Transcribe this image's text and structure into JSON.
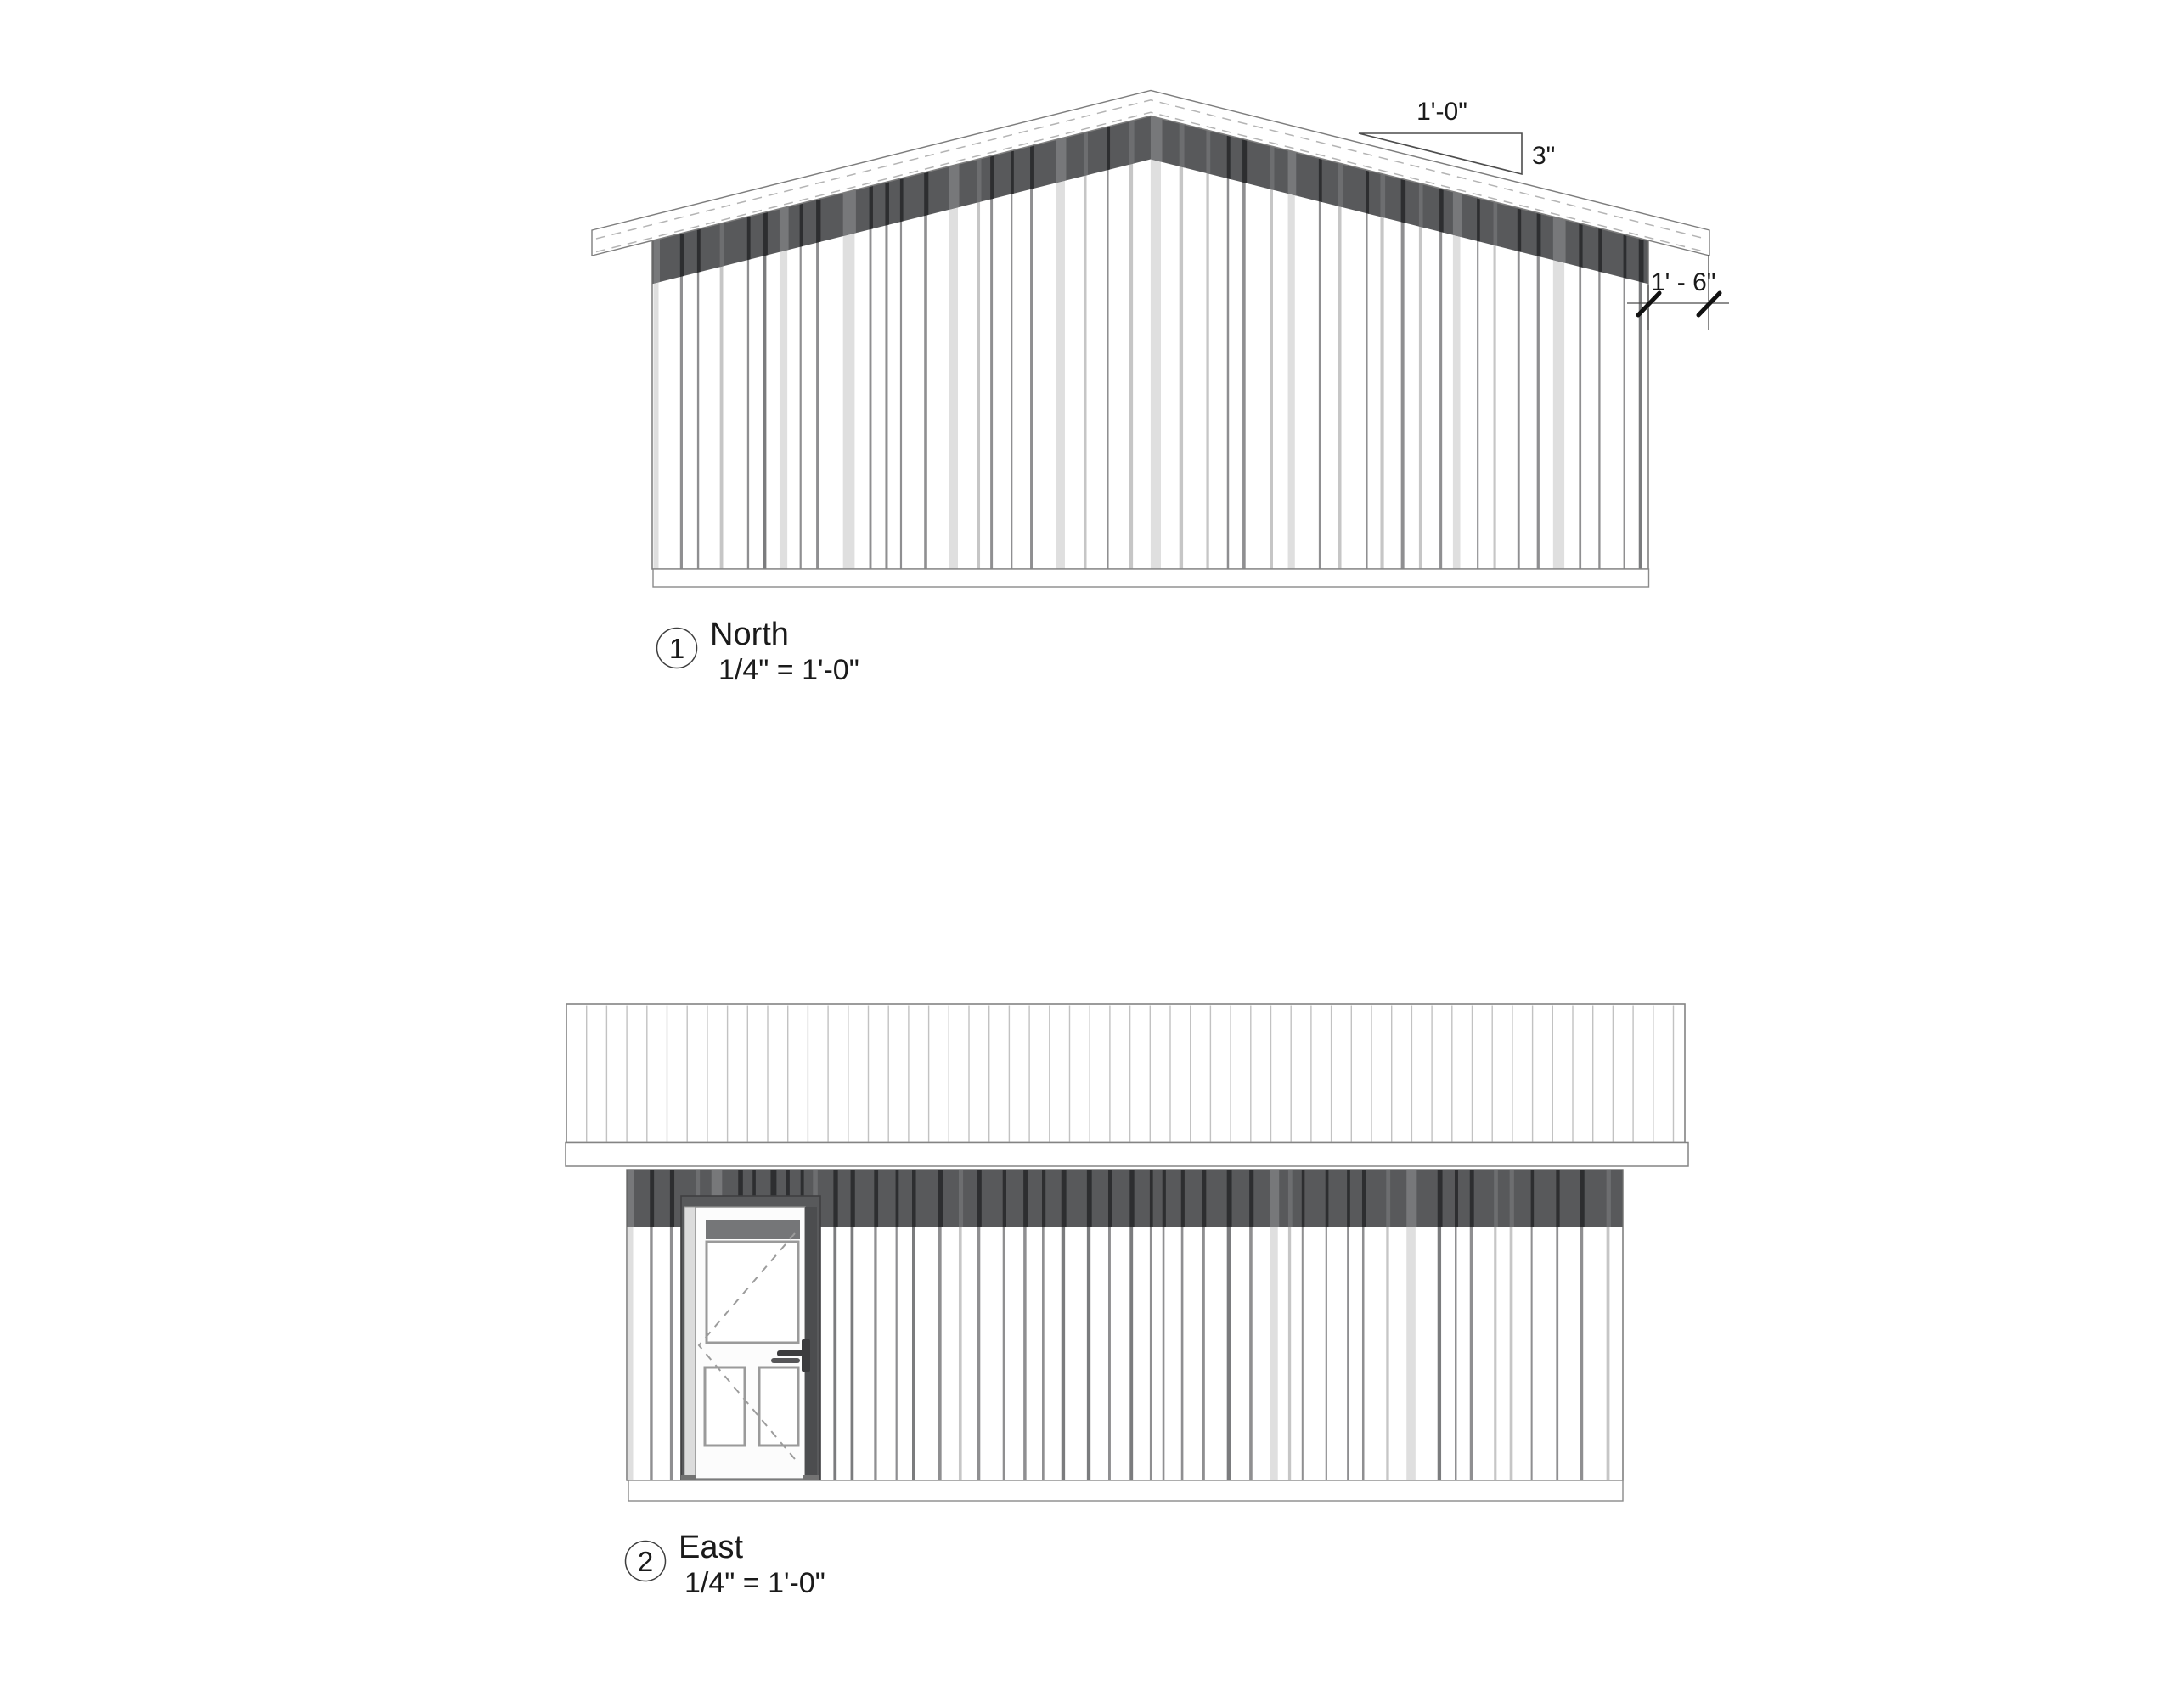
{
  "sheet": {
    "background": "#ffffff"
  },
  "views": [
    {
      "number": "1",
      "title": "North",
      "scale": "1/4\" = 1'-0\""
    },
    {
      "number": "2",
      "title": "East",
      "scale": "1/4\" = 1'-0\""
    }
  ],
  "annotations": {
    "slope_run": "1'-0\"",
    "slope_rise": "3\"",
    "eave_overhang": "1' - 6\""
  },
  "colors": {
    "dark_band": "#58595b",
    "band_seam": "#2d2e30",
    "band_seam_soft": "#3a3b3d",
    "band_streak_light": "#6d6e70",
    "band_panel_light": "#77787a",
    "siding_seam": "#8f8f91",
    "siding_seam_soft": "#7b7c7e",
    "siding_line_light": "#c6c6c6",
    "siding_panel_light": "#dfdfdf",
    "roof_seam": "#c2c2c2",
    "door_jamb_dark": "#4c4d4f",
    "door_transom": "#757678",
    "door_hardware": "#3c3c3e"
  }
}
